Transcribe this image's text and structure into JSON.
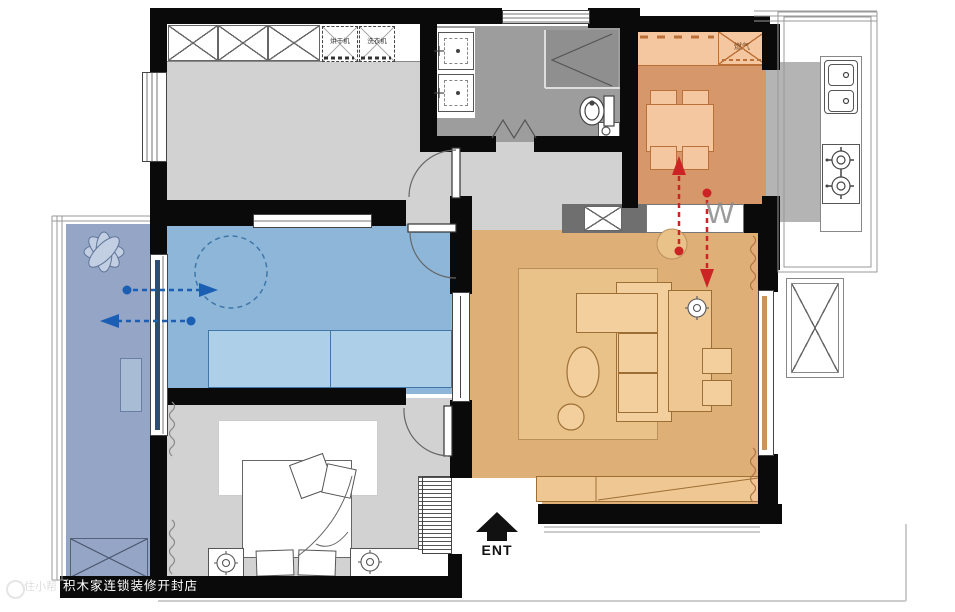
{
  "labels": {
    "dryer": "烘干机",
    "washer": "洗衣机",
    "gas_meter": "燃气",
    "w_watermark": "W",
    "entrance": "ENT"
  },
  "watermark": {
    "store": "积木家连锁装修开封店",
    "logo": "住小帮"
  },
  "colors": {
    "wall": "#0a0a0a",
    "floor-gray": "#d2d2d2",
    "bath-gray": "#9d9d9d",
    "shower-gray": "#8f8f8f",
    "kitchen-gray": "#b4b4b4",
    "dining-floor": "#d6986a",
    "dining-furn": "#f5c7a0",
    "dining-line": "#bb7038",
    "living-floor": "#deb078",
    "living-rug": "#e9c28a",
    "living-furn": "#f2cf9c",
    "living-line": "#9d6f35",
    "blue-floor": "#8db6d8",
    "blue-furn": "#aecfe8",
    "blue-line": "#4077a8",
    "balcony-floor": "#94a5c6",
    "arrow-red": "#cc2424",
    "arrow-blue": "#1a5fb4"
  }
}
